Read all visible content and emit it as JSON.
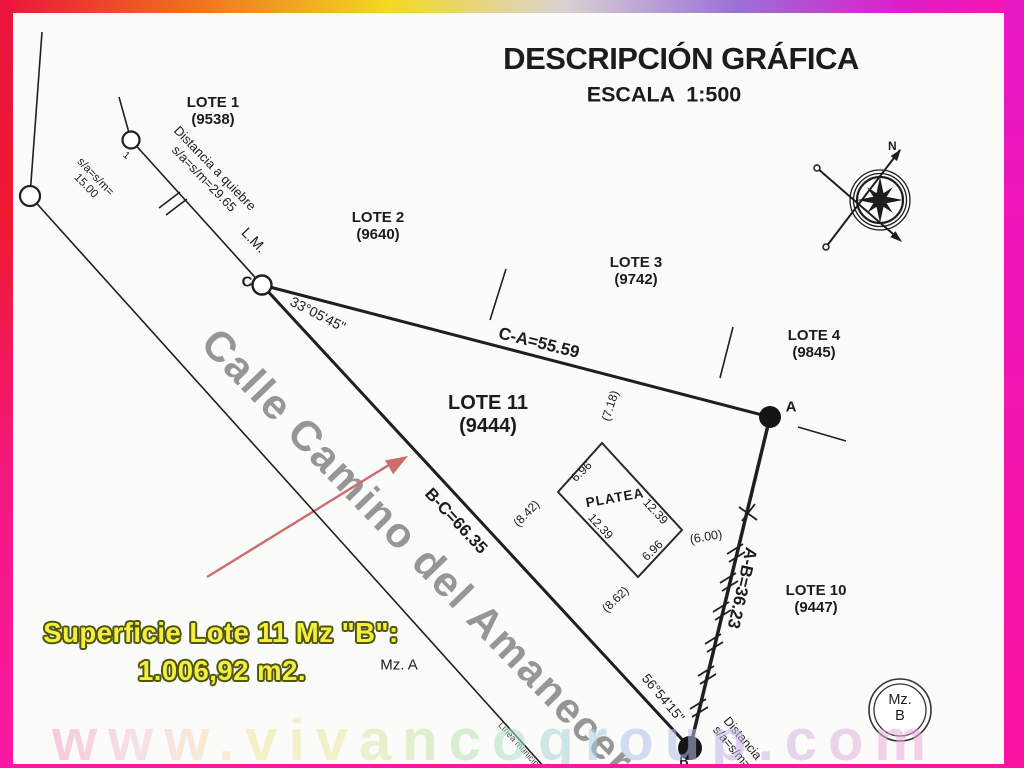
{
  "header": {
    "title": "DESCRIPCIÓN GRÁFICA",
    "scale": "ESCALA  1:500"
  },
  "compass": {
    "north": "N"
  },
  "lots": {
    "lote1": {
      "name": "LOTE 1",
      "id": "(9538)"
    },
    "lote2": {
      "name": "LOTE 2",
      "id": "(9640)"
    },
    "lote3": {
      "name": "LOTE 3",
      "id": "(9742)"
    },
    "lote4": {
      "name": "LOTE 4",
      "id": "(9845)"
    },
    "lote10": {
      "name": "LOTE 10",
      "id": "(9447)"
    },
    "lote11": {
      "name": "LOTE 11",
      "id": "(9444)"
    }
  },
  "points": {
    "a": "A",
    "b": "B",
    "c": "C",
    "n1": "1"
  },
  "edges": {
    "ca": "C-A=55.59",
    "bc": "B-C=66.35",
    "ab": "A-B=36.23"
  },
  "angles": {
    "at_c": "33°05'45\"",
    "at_b": "56°54'15\""
  },
  "annotations": {
    "quiebre1": "Distancia a quiebre",
    "quiebre2": "s/a=s/m=29.65",
    "sa1": "s/a=s/m=",
    "sa2": "15.00",
    "lm": "L.M.",
    "dist_b1": "Distancia",
    "dist_b2": "s/a=s/m=",
    "linea": "Línea municipal",
    "mz_a": "Mz. A",
    "mz_b1": "Mz.",
    "mz_b2": "B"
  },
  "platea": {
    "label": "PLATEA",
    "side_top_left": "6.96",
    "side_top_right": "12.39",
    "side_bottom_left": "12.39",
    "side_bottom_right": "6.96",
    "offset": "(6.00)",
    "d1": "(7.18)",
    "d2": "(8.42)",
    "d3": "(8.62)"
  },
  "street": "Calle Camino del Amanecer",
  "area": {
    "line1": "Superficie Lote 11 Mz \"B\":",
    "line2": "1.006,92 m2."
  },
  "watermark": "www.vivancogroup.com",
  "colors": {
    "arrow_red": "#cf6d6d",
    "area_fill": "#f4ef3d",
    "area_outline": "#50550c",
    "street_gray": "#7d7d7d",
    "line_black": "#1f1f1f"
  }
}
